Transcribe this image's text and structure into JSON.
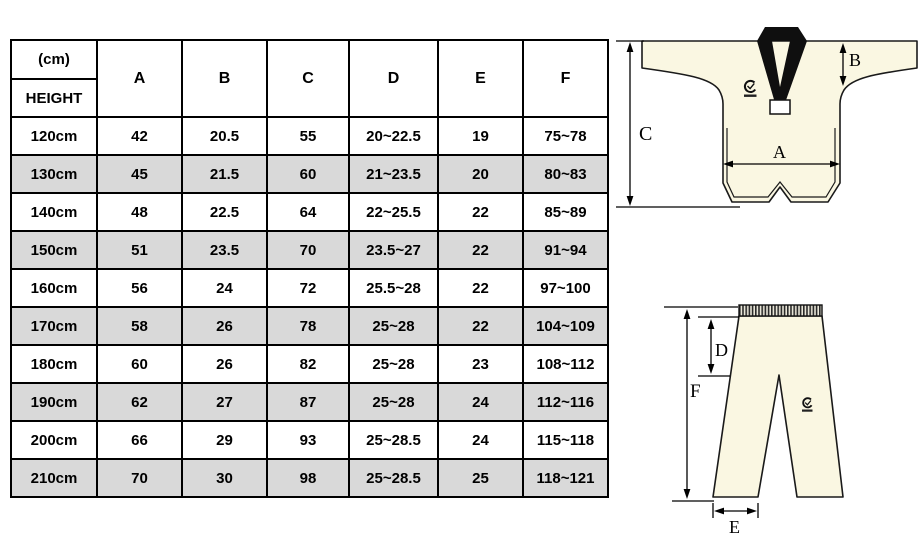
{
  "chart_data": {
    "type": "table",
    "corner_header": {
      "top": "(cm)",
      "bottom": "HEIGHT"
    },
    "columns": [
      "A",
      "B",
      "C",
      "D",
      "E",
      "F"
    ],
    "rows": [
      [
        "120cm",
        "42",
        "20.5",
        "55",
        "20~22.5",
        "19",
        "75~78"
      ],
      [
        "130cm",
        "45",
        "21.5",
        "60",
        "21~23.5",
        "20",
        "80~83"
      ],
      [
        "140cm",
        "48",
        "22.5",
        "64",
        "22~25.5",
        "22",
        "85~89"
      ],
      [
        "150cm",
        "51",
        "23.5",
        "70",
        "23.5~27",
        "22",
        "91~94"
      ],
      [
        "160cm",
        "56",
        "24",
        "72",
        "25.5~28",
        "22",
        "97~100"
      ],
      [
        "170cm",
        "58",
        "26",
        "78",
        "25~28",
        "22",
        "104~109"
      ],
      [
        "180cm",
        "60",
        "26",
        "82",
        "25~28",
        "23",
        "108~112"
      ],
      [
        "190cm",
        "62",
        "27",
        "87",
        "25~28",
        "24",
        "112~116"
      ],
      [
        "200cm",
        "66",
        "29",
        "93",
        "25~28.5",
        "24",
        "115~118"
      ],
      [
        "210cm",
        "70",
        "30",
        "98",
        "25~28.5",
        "25",
        "118~121"
      ]
    ],
    "legend_position": "none",
    "grid": true
  },
  "diagrams": {
    "jacket": {
      "dimension_labels": [
        "A",
        "B",
        "C"
      ]
    },
    "pants": {
      "dimension_labels": [
        "D",
        "E",
        "F"
      ]
    }
  },
  "colors": {
    "garment_fill": "#faf7e2",
    "collar": "#0f0f0f",
    "outline": "#1a1a1a",
    "alt_row": "#d9d9d9",
    "table_border": "#000000"
  }
}
